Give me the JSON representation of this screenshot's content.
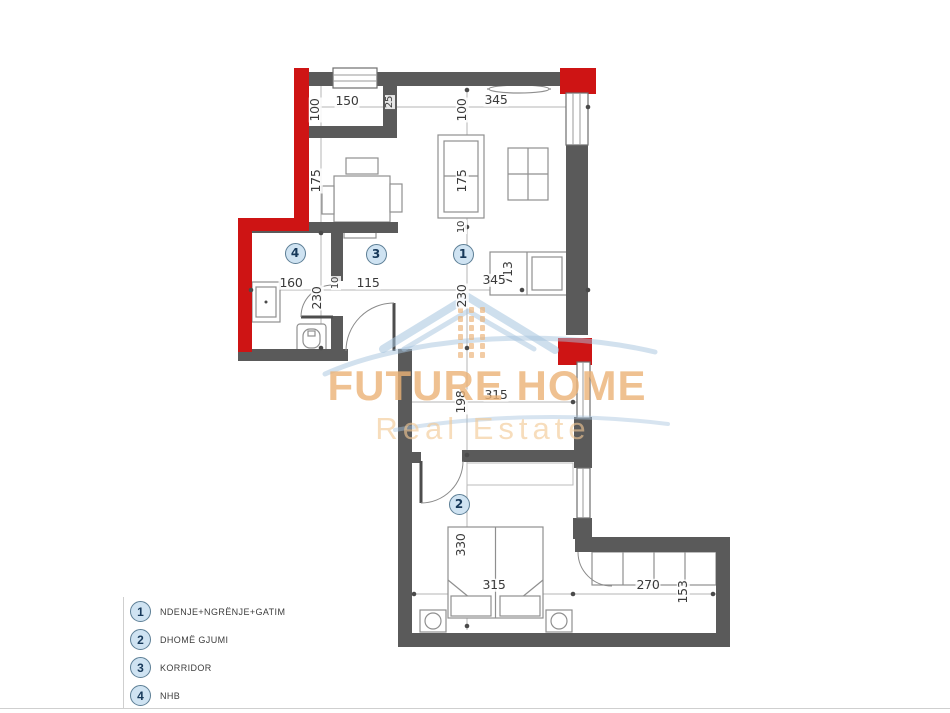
{
  "watermark": {
    "line1": "FUTURE HOME",
    "line2": "Real Estate"
  },
  "legend": {
    "items": [
      {
        "number": "1",
        "label": "NDENJE+NGRËNJE+GATIM"
      },
      {
        "number": "2",
        "label": "DHOMË GJUMI"
      },
      {
        "number": "3",
        "label": "KORRIDOR"
      },
      {
        "number": "4",
        "label": "NHB"
      }
    ]
  },
  "markers": [
    {
      "number": "1",
      "x": 463,
      "y": 254
    },
    {
      "number": "2",
      "x": 459,
      "y": 504
    },
    {
      "number": "3",
      "x": 376,
      "y": 254
    },
    {
      "number": "4",
      "x": 295,
      "y": 253
    }
  ],
  "dimensions": [
    {
      "text": "100",
      "x": 315,
      "y": 110,
      "rot": -90
    },
    {
      "text": "150",
      "x": 347,
      "y": 101,
      "rot": 0
    },
    {
      "text": "25",
      "x": 390,
      "y": 102,
      "rot": -90,
      "small": true
    },
    {
      "text": "100",
      "x": 462,
      "y": 110,
      "rot": -90
    },
    {
      "text": "345",
      "x": 496,
      "y": 100,
      "rot": 0
    },
    {
      "text": "175",
      "x": 316,
      "y": 181,
      "rot": -90
    },
    {
      "text": "175",
      "x": 462,
      "y": 181,
      "rot": -90
    },
    {
      "text": "10",
      "x": 462,
      "y": 227,
      "rot": -90,
      "small": true
    },
    {
      "text": "713",
      "x": 508,
      "y": 273,
      "rot": -90
    },
    {
      "text": "345",
      "x": 494,
      "y": 280,
      "rot": 0
    },
    {
      "text": "230",
      "x": 462,
      "y": 296,
      "rot": -90
    },
    {
      "text": "160",
      "x": 291,
      "y": 283,
      "rot": 0
    },
    {
      "text": "230",
      "x": 317,
      "y": 298,
      "rot": -90
    },
    {
      "text": "10",
      "x": 336,
      "y": 283,
      "rot": -90,
      "small": true
    },
    {
      "text": "115",
      "x": 368,
      "y": 283,
      "rot": 0
    },
    {
      "text": "198",
      "x": 461,
      "y": 402,
      "rot": -90
    },
    {
      "text": "315",
      "x": 496,
      "y": 395,
      "rot": 0
    },
    {
      "text": "330",
      "x": 461,
      "y": 545,
      "rot": -90
    },
    {
      "text": "315",
      "x": 494,
      "y": 585,
      "rot": 0
    },
    {
      "text": "270",
      "x": 648,
      "y": 585,
      "rot": 0
    },
    {
      "text": "153",
      "x": 683,
      "y": 592,
      "rot": -90
    }
  ],
  "colors": {
    "wall": "#5a5a5a",
    "wall_red": "#ce1414",
    "dim_line": "#b5b5b5",
    "dim_text": "#3a3a3a",
    "furniture": "#8f8f8f",
    "marker_fill": "#cfe3f2",
    "marker_border": "#5c7e95",
    "marker_text": "#17395a",
    "wm_orange": "#ecb276",
    "wm_orange_light": "#f3c994",
    "wm_blue": "#a6c4de",
    "edge_line": "#cfcfcf"
  }
}
